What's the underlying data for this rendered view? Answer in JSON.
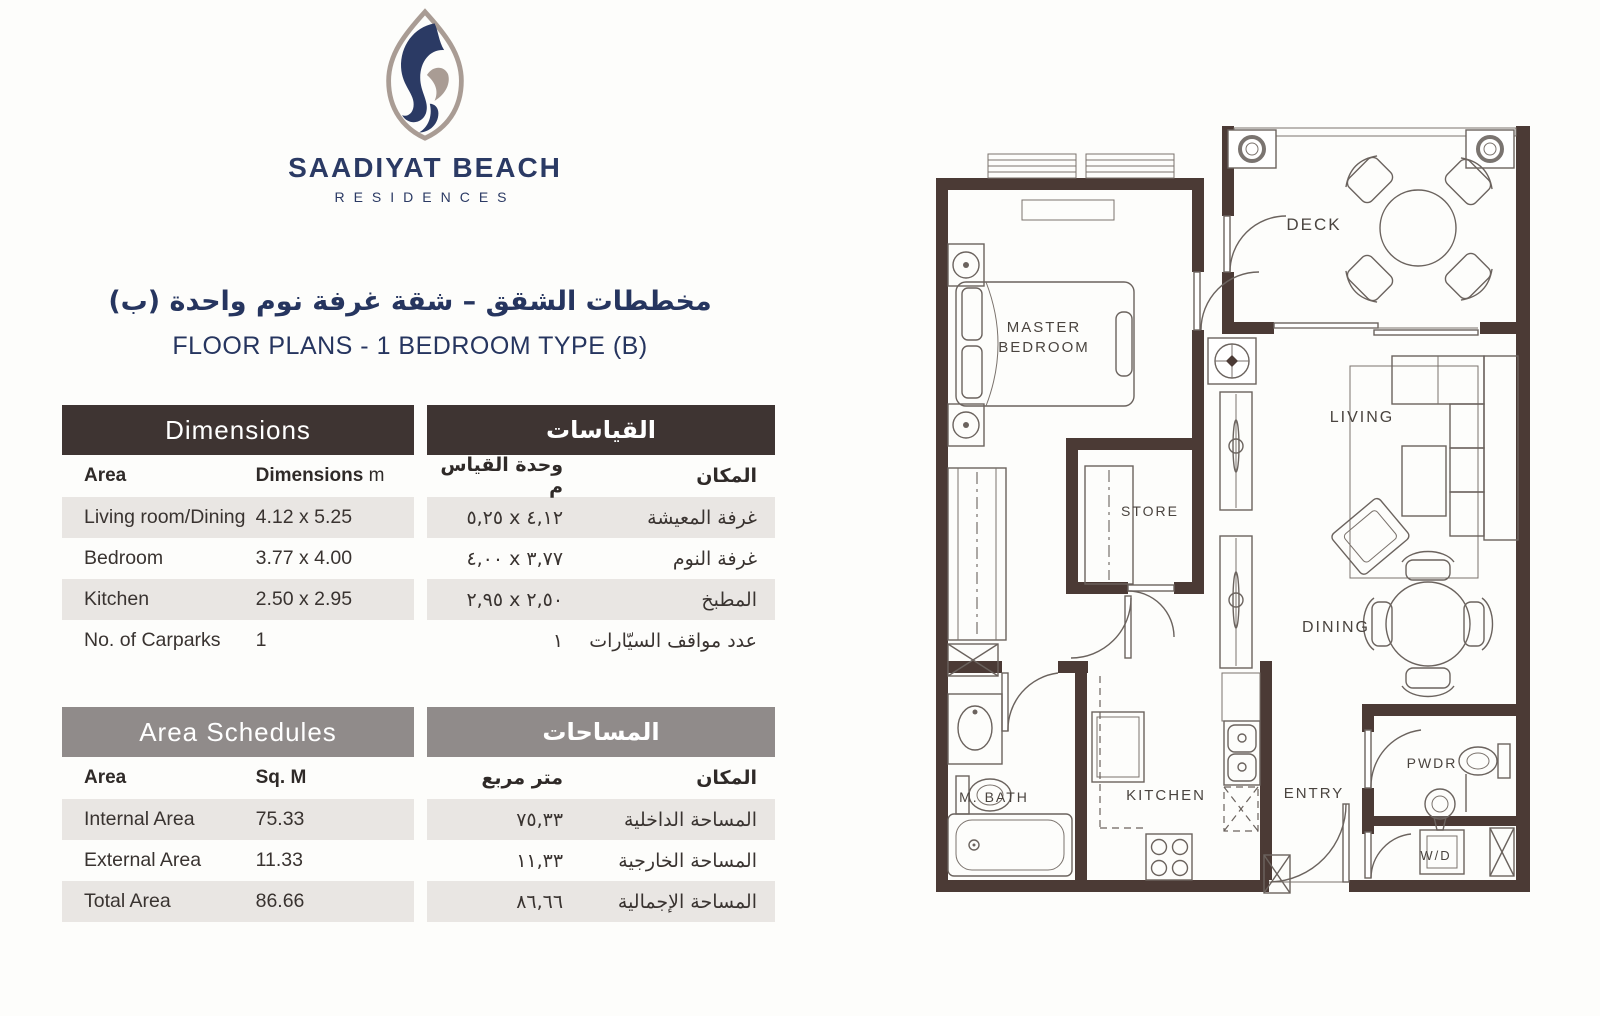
{
  "logo": {
    "name": "SAADIYAT BEACH",
    "subtitle": "RESIDENCES"
  },
  "title": {
    "arabic": "مخططات الشقق – شقة غرفة نوم واحدة (ب)",
    "english": "FLOOR PLANS - 1 BEDROOM TYPE (B)"
  },
  "colors": {
    "navy": "#2b3a64",
    "taupe": "#a99c94",
    "header_dark": "#3e3432",
    "header_gray": "#908b8a",
    "row_gray": "#e9e6e3",
    "wall_brown": "#4b3a35"
  },
  "tables": {
    "dimensions_en": {
      "title": "Dimensions",
      "col_area": "Area",
      "col_value": "Dimensions",
      "col_unit": "m",
      "rows": [
        {
          "label": "Living room/Dining",
          "value": "4.12 x 5.25"
        },
        {
          "label": "Bedroom",
          "value": "3.77 x 4.00"
        },
        {
          "label": "Kitchen",
          "value": "2.50 x 2.95"
        },
        {
          "label": "No. of Carparks",
          "value": "1"
        }
      ]
    },
    "dimensions_ar": {
      "title": "القياسات",
      "col_area": "المكان",
      "col_value": "وحدة القياس م",
      "rows": [
        {
          "label": "غرفة المعيشة",
          "value": "٥,٢٥ x ٤,١٢"
        },
        {
          "label": "غرفة النوم",
          "value": "٤,٠٠ x ٣,٧٧"
        },
        {
          "label": "المطبخ",
          "value": "٢,٩٥ x ٢,٥٠"
        },
        {
          "label": "عدد مواقف السيّارات",
          "value": "١"
        }
      ]
    },
    "areas_en": {
      "title": "Area Schedules",
      "col_area": "Area",
      "col_value": "Sq. M",
      "rows": [
        {
          "label": "Internal Area",
          "value": "75.33"
        },
        {
          "label": "External Area",
          "value": "11.33"
        },
        {
          "label": "Total Area",
          "value": "86.66"
        }
      ]
    },
    "areas_ar": {
      "title": "المساحات",
      "col_area": "المكان",
      "col_value": "متر مربع",
      "rows": [
        {
          "label": "المساحة الداخلية",
          "value": "٧٥,٣٣"
        },
        {
          "label": "المساحة الخارجية",
          "value": "١١,٣٣"
        },
        {
          "label": "المساحة الإجمالية",
          "value": "٨٦,٦٦"
        }
      ]
    }
  },
  "plan": {
    "rooms": {
      "deck": "DECK",
      "master_1": "MASTER",
      "master_2": "BEDROOM",
      "living": "LIVING",
      "store": "STORE",
      "dining": "DINING",
      "m_bath": "M. BATH",
      "kitchen": "KITCHEN",
      "entry": "ENTRY",
      "pwdr": "PWDR",
      "wd": "W/D"
    }
  }
}
